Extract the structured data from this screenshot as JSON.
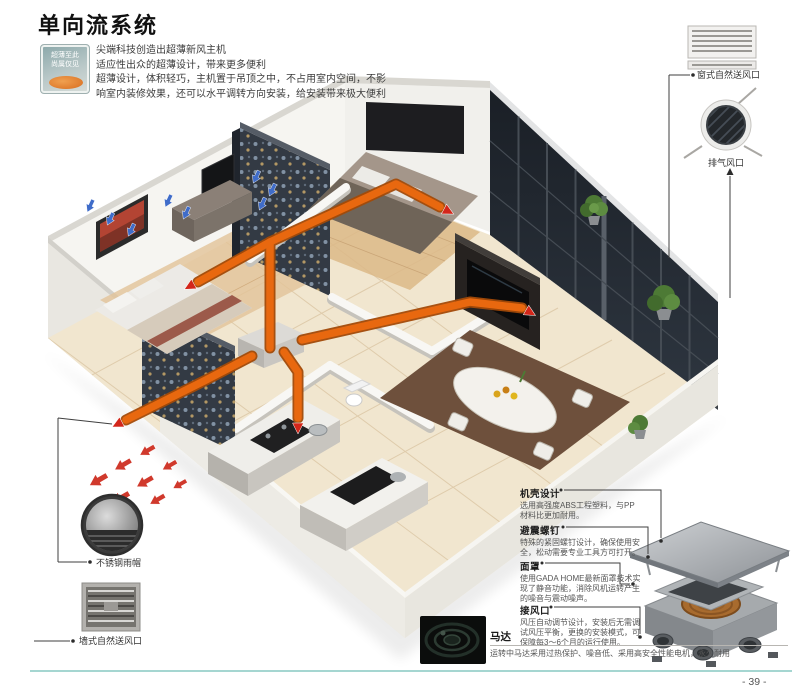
{
  "page": {
    "title": "单向流系统",
    "page_number": "- 39 -"
  },
  "badge": {
    "line1": "超薄至此",
    "line2": "尚属仅见"
  },
  "intro": {
    "lines": [
      "尖端科技创造出超薄新风主机",
      "适应性出众的超薄设计，带来更多便利",
      "超薄设计，体积轻巧，主机置于吊顶之中，不占用室内空间，不影",
      "响室内装修效果，还可以水平调转方向安装，给安装带来极大便利"
    ]
  },
  "callouts": {
    "window_vent": "窗式自然送风口",
    "exhaust_vent": "排气风口",
    "rain_cap": "不锈钢雨帽",
    "wall_vent": "墙式自然送风口"
  },
  "features": [
    {
      "title": "机壳设计",
      "desc": "选用高强度ABS工程塑料，与PP材料比更加耐用。"
    },
    {
      "title": "避震螺钉",
      "desc": "特殊的紧固螺钉设计，确保使用安全，松动需要专业工具方可打开。"
    },
    {
      "title": "面罩",
      "desc": "使用GADA HOME最新面罩技术实现了静音功能，消除风机运转产生的噪音与震动噪声。"
    },
    {
      "title": "接风口",
      "desc": "风压自动调节设计，安装后无需调试风压平衡，更换的安装模式，可保障每3～6个月的运行使用。"
    }
  ],
  "motor": {
    "title": "马达",
    "desc": "运转中马达采用过热保护、噪音低、采用高安全性能电机，永久耐用"
  },
  "colors": {
    "duct_orange": "#e8680f",
    "supply_arrow_blue": "#3f6cc9",
    "exhaust_arrow_red": "#d0392c",
    "footer_rule_teal": "#a5d6d1"
  }
}
